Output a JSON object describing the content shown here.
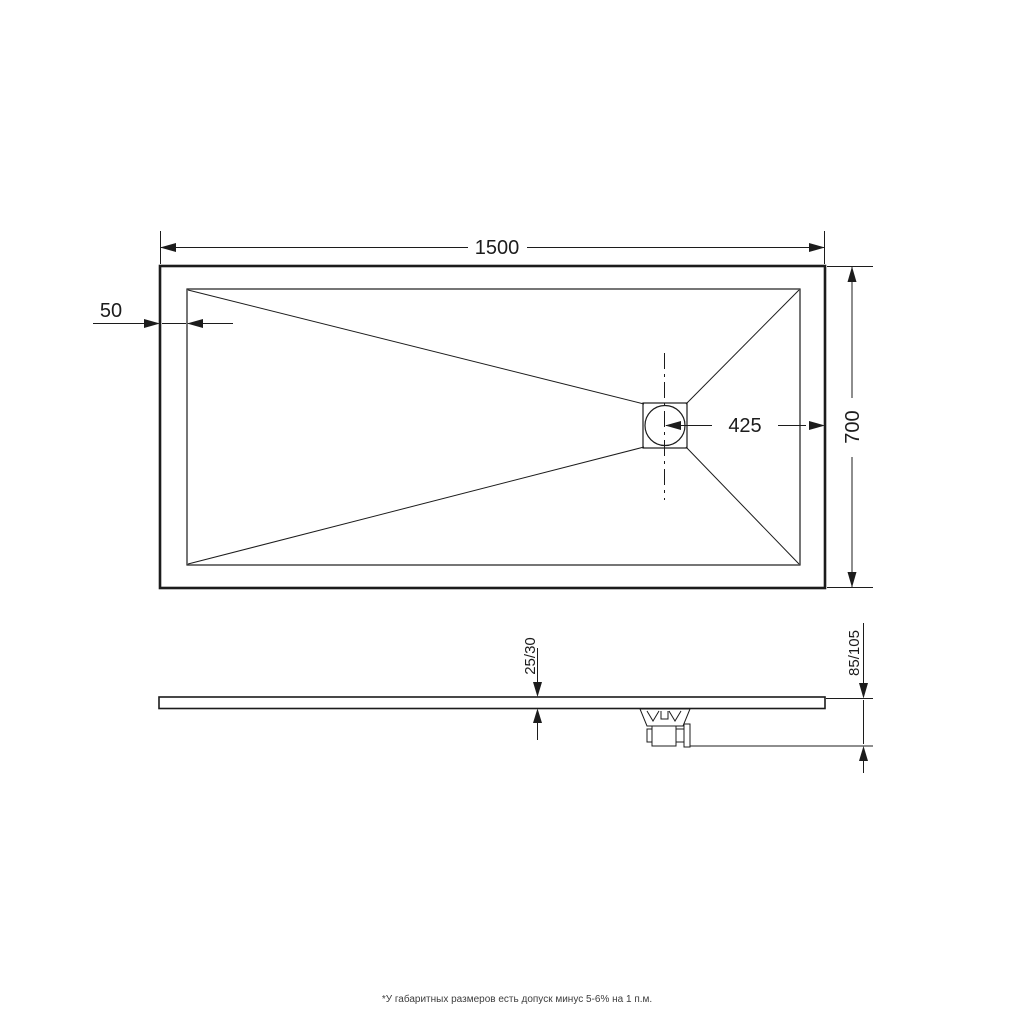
{
  "drawing": {
    "dimensions": {
      "top_width": "1500",
      "edge_offset": "50",
      "drain_offset": "425",
      "depth": "700",
      "tray_thickness": "25/30",
      "total_height": "85/105"
    },
    "footnote": "*У габаритных размеров есть допуск минус  5-6% на 1 п.м.",
    "colors": {
      "line": "#1c1c1c",
      "background": "#ffffff"
    }
  }
}
